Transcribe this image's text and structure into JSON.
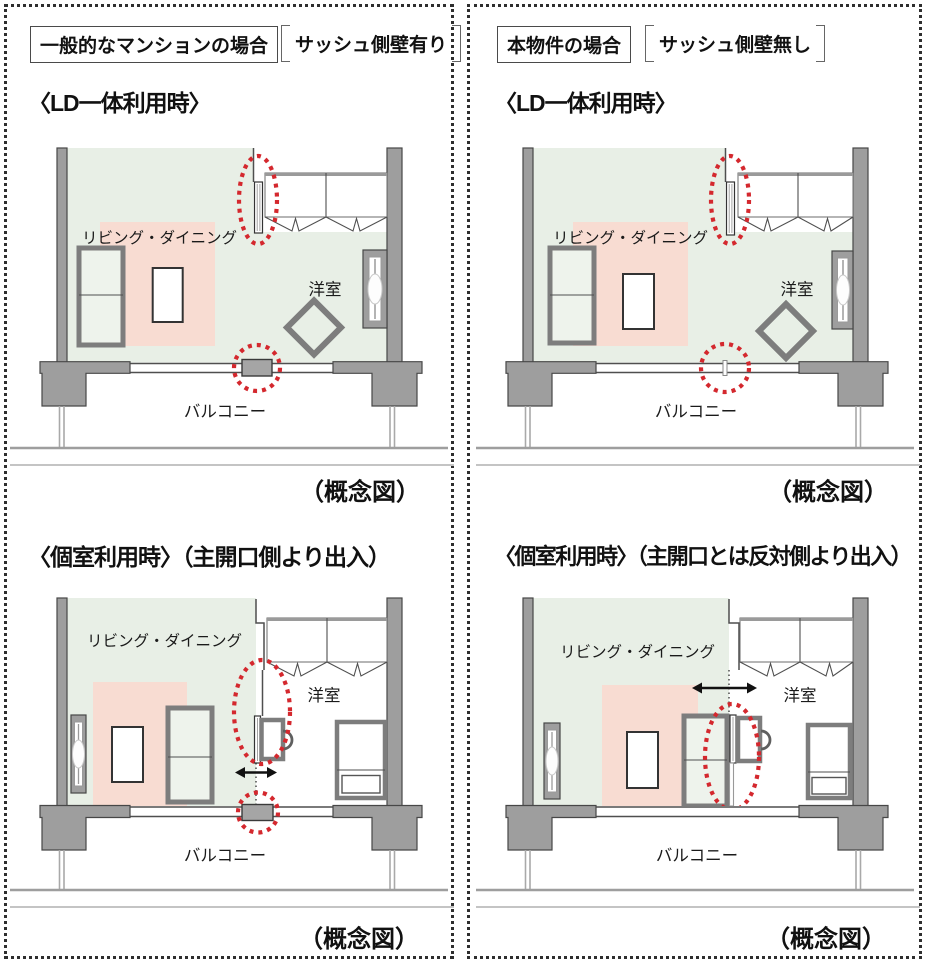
{
  "headers": {
    "left_tag": "一般的なマンションの場合",
    "left_condition": "サッシュ側壁有り",
    "right_tag": "本物件の場合",
    "right_condition": "サッシュ側壁無し",
    "top_left_title": "〈LD一体利用時〉",
    "top_right_title": "〈LD一体利用時〉",
    "bottom_left_title": "〈個室利用時〉（主開口側より出入）",
    "bottom_right_title": "〈個室利用時〉（主開口とは反対側より出入）"
  },
  "diagram_labels": {
    "living_dining": "リビング・ダイニング",
    "western_room": "洋室",
    "balcony": "バルコニー",
    "caption": "（概念図）"
  },
  "colors": {
    "highlight_red": "#d4282e",
    "wall_gray": "#9e9e9e",
    "ld_area_pink": "#f8dcd2",
    "floor_green": "#e8efe6"
  }
}
